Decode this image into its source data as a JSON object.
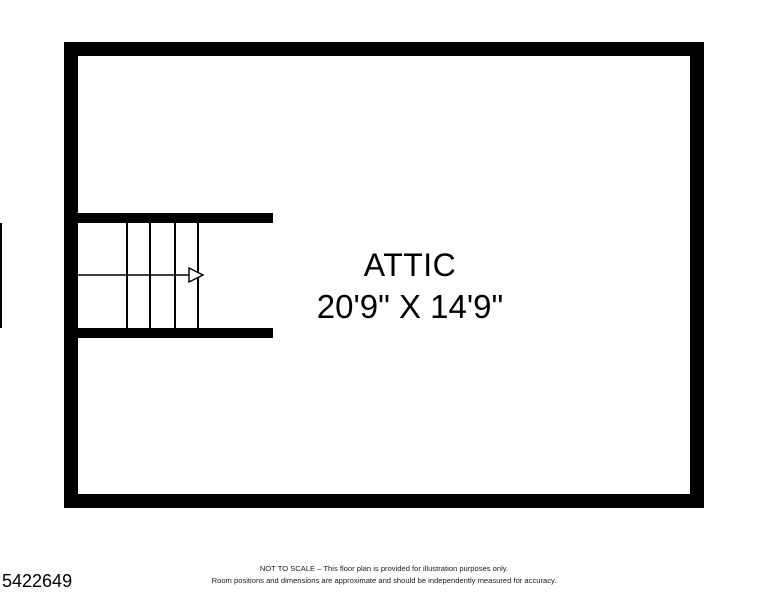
{
  "floor_plan": {
    "room_label": "ATTIC",
    "room_dimensions": "20'9\" X 14'9\"",
    "stairs": {
      "tread_count": 5,
      "direction": "right"
    },
    "colors": {
      "wall": "#000000",
      "background": "#ffffff",
      "text": "#000000"
    }
  },
  "footer": {
    "listing_id": "5422649",
    "disclaimer_line1": "NOT TO SCALE – This floor plan is provided for illustration purposes only.",
    "disclaimer_line2": "Room positions and dimensions are approximate and should be independently measured for accuracy."
  }
}
